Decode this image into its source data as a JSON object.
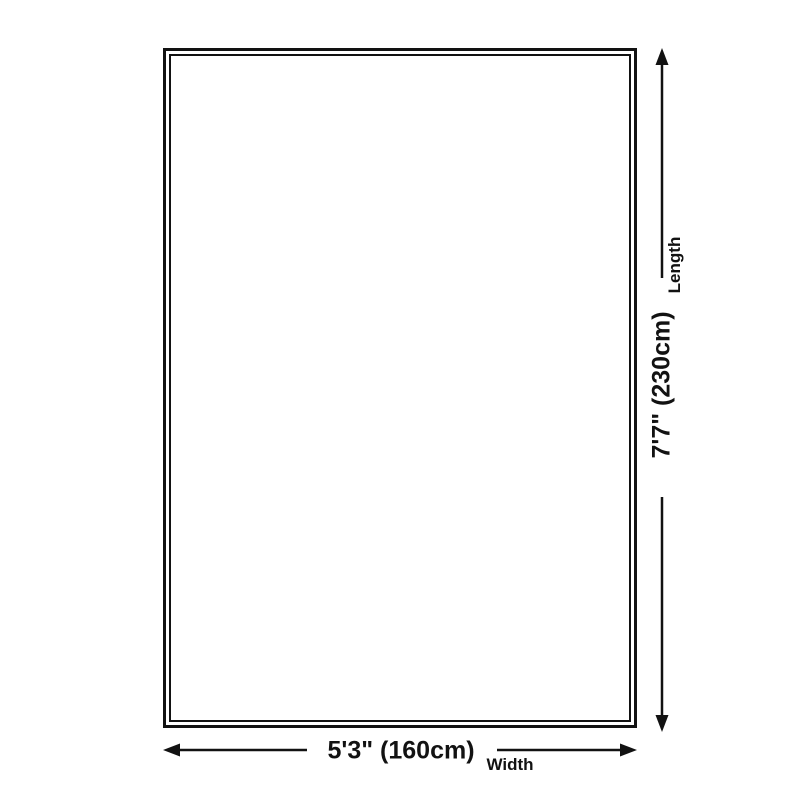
{
  "diagram": {
    "background_color": "#ffffff",
    "line_color": "#121212",
    "product_box": {
      "shape": "rectangle",
      "border_style": "double"
    },
    "length": {
      "value": "7'7\" (230cm)",
      "label": "Length",
      "feet_inches": "7'7\"",
      "centimeters": "230cm",
      "orientation": "vertical"
    },
    "width": {
      "value": "5'3\" (160cm)",
      "label": "Width",
      "feet_inches": "5'3\"",
      "centimeters": "160cm",
      "orientation": "horizontal"
    }
  }
}
